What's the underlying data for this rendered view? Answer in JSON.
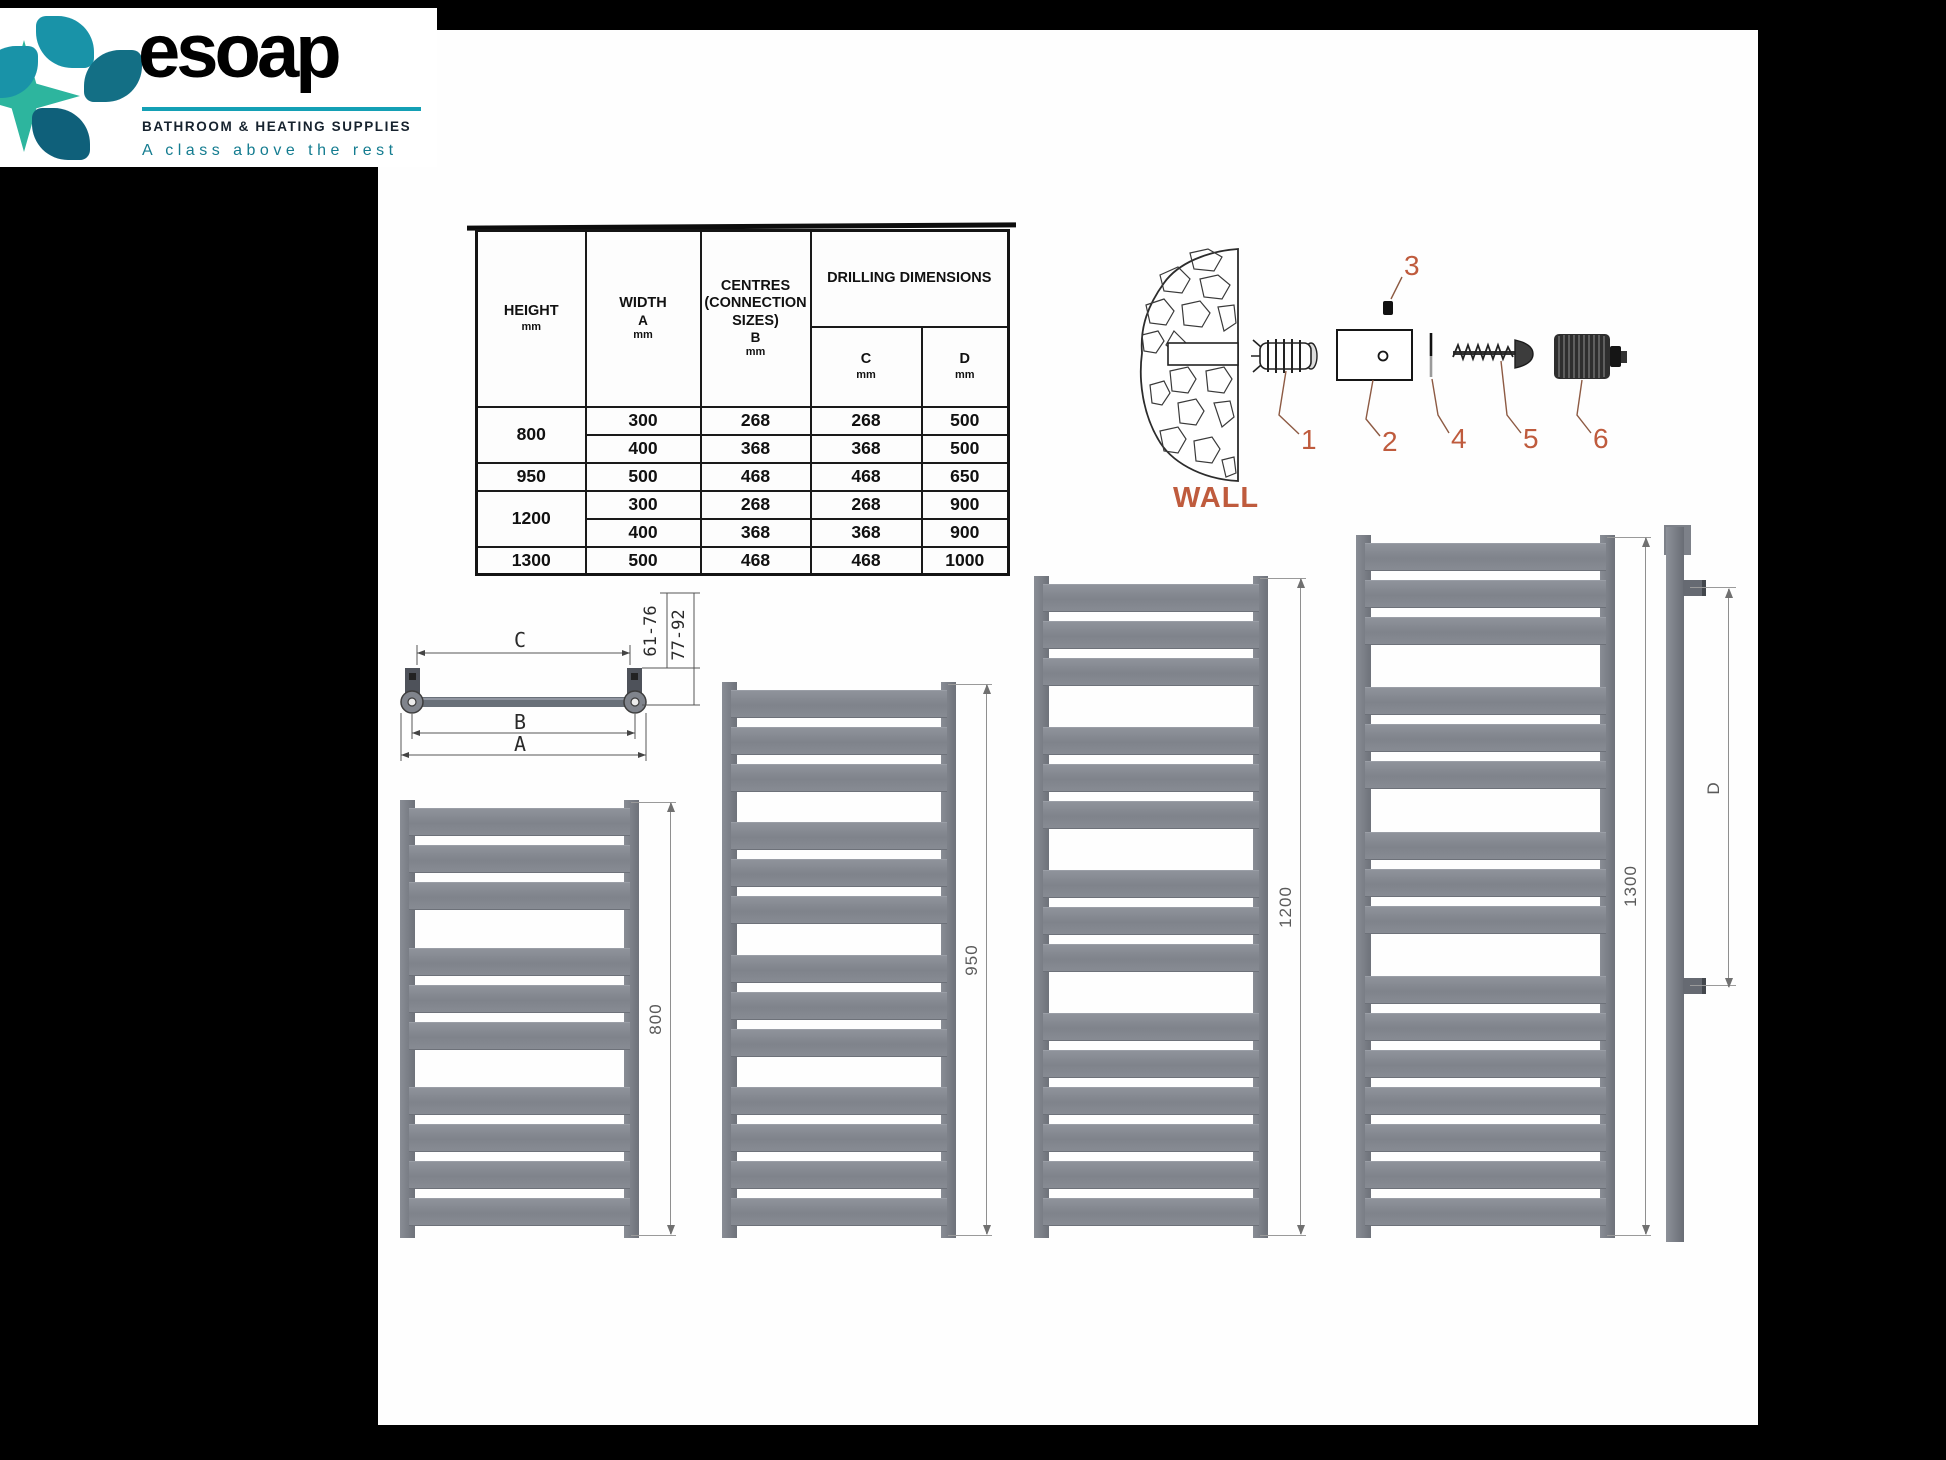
{
  "brand": {
    "name": "esoap",
    "subtitle": "BATHROOM & HEATING SUPPLIES",
    "tagline": "A class above the rest",
    "colors": {
      "teal": "#1993a8",
      "teal_dark": "#136f85",
      "green": "#2db59e",
      "rule": "#14a0b5",
      "tagline": "#147c90"
    }
  },
  "spec_table": {
    "columns": {
      "height": {
        "label": "HEIGHT",
        "unit": "mm"
      },
      "width": {
        "label": "WIDTH",
        "sub": "A",
        "unit": "mm"
      },
      "centres": {
        "label": "CENTRES\n(CONNECTION\nSIZES)",
        "sub": "B",
        "unit": "mm"
      },
      "drilling": {
        "label": "DRILLING DIMENSIONS"
      },
      "c": {
        "label": "C",
        "unit": "mm"
      },
      "d": {
        "label": "D",
        "unit": "mm"
      }
    },
    "rows": [
      {
        "height": "800",
        "rowspan": 2,
        "width": "300",
        "centres": "268",
        "c": "268",
        "d": "500"
      },
      {
        "width": "400",
        "centres": "368",
        "c": "368",
        "d": "500"
      },
      {
        "height": "950",
        "rowspan": 1,
        "width": "500",
        "centres": "468",
        "c": "468",
        "d": "650"
      },
      {
        "height": "1200",
        "rowspan": 2,
        "width": "300",
        "centres": "268",
        "c": "268",
        "d": "900"
      },
      {
        "width": "400",
        "centres": "368",
        "c": "368",
        "d": "900"
      },
      {
        "height": "1300",
        "rowspan": 1,
        "width": "500",
        "centres": "468",
        "c": "468",
        "d": "1000"
      }
    ]
  },
  "installation": {
    "wall_label": "WALL",
    "part_numbers": [
      "1",
      "2",
      "3",
      "4",
      "5",
      "6"
    ],
    "accent_color": "#bf5b3d"
  },
  "top_view": {
    "dim_c": "C",
    "dim_b": "B",
    "dim_a": "A",
    "range_inner": "61-76",
    "range_outer": "77-92"
  },
  "radiators": [
    {
      "label": "800",
      "groups": [
        3,
        3,
        4
      ]
    },
    {
      "label": "950",
      "groups": [
        3,
        3,
        3,
        4
      ]
    },
    {
      "label": "1200",
      "groups": [
        3,
        3,
        3,
        6
      ]
    },
    {
      "label": "1300",
      "groups": [
        3,
        3,
        3,
        7
      ]
    }
  ],
  "side_view": {
    "dim_label": "D"
  }
}
